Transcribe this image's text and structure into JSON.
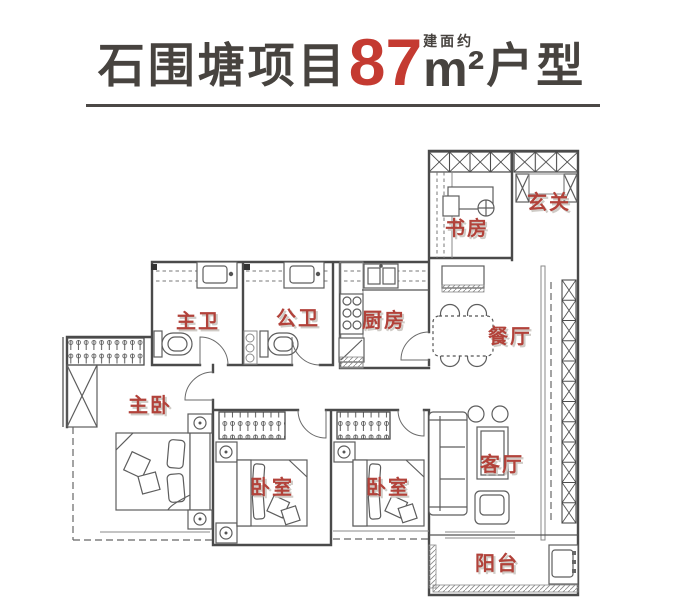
{
  "title": {
    "project_name": "石围塘项目",
    "area_value": "87",
    "area_prefix": "建面约",
    "area_unit": "m²",
    "type_suffix": "户型"
  },
  "colors": {
    "accent_red": "#c43a31",
    "room_label_red": "#b2423a",
    "title_dark": "#47433f",
    "wall_gray": "#4a4a4a"
  },
  "rooms": [
    {
      "name": "study",
      "label": "书房"
    },
    {
      "name": "entry",
      "label": "玄关"
    },
    {
      "name": "master-bath",
      "label": "主卫"
    },
    {
      "name": "public-bath",
      "label": "公卫"
    },
    {
      "name": "kitchen",
      "label": "厨房"
    },
    {
      "name": "dining",
      "label": "餐厅"
    },
    {
      "name": "master-bedroom",
      "label": "主卧"
    },
    {
      "name": "bedroom-a",
      "label": "卧室"
    },
    {
      "name": "bedroom-b",
      "label": "卧室"
    },
    {
      "name": "living",
      "label": "客厅"
    },
    {
      "name": "balcony",
      "label": "阳台"
    }
  ]
}
